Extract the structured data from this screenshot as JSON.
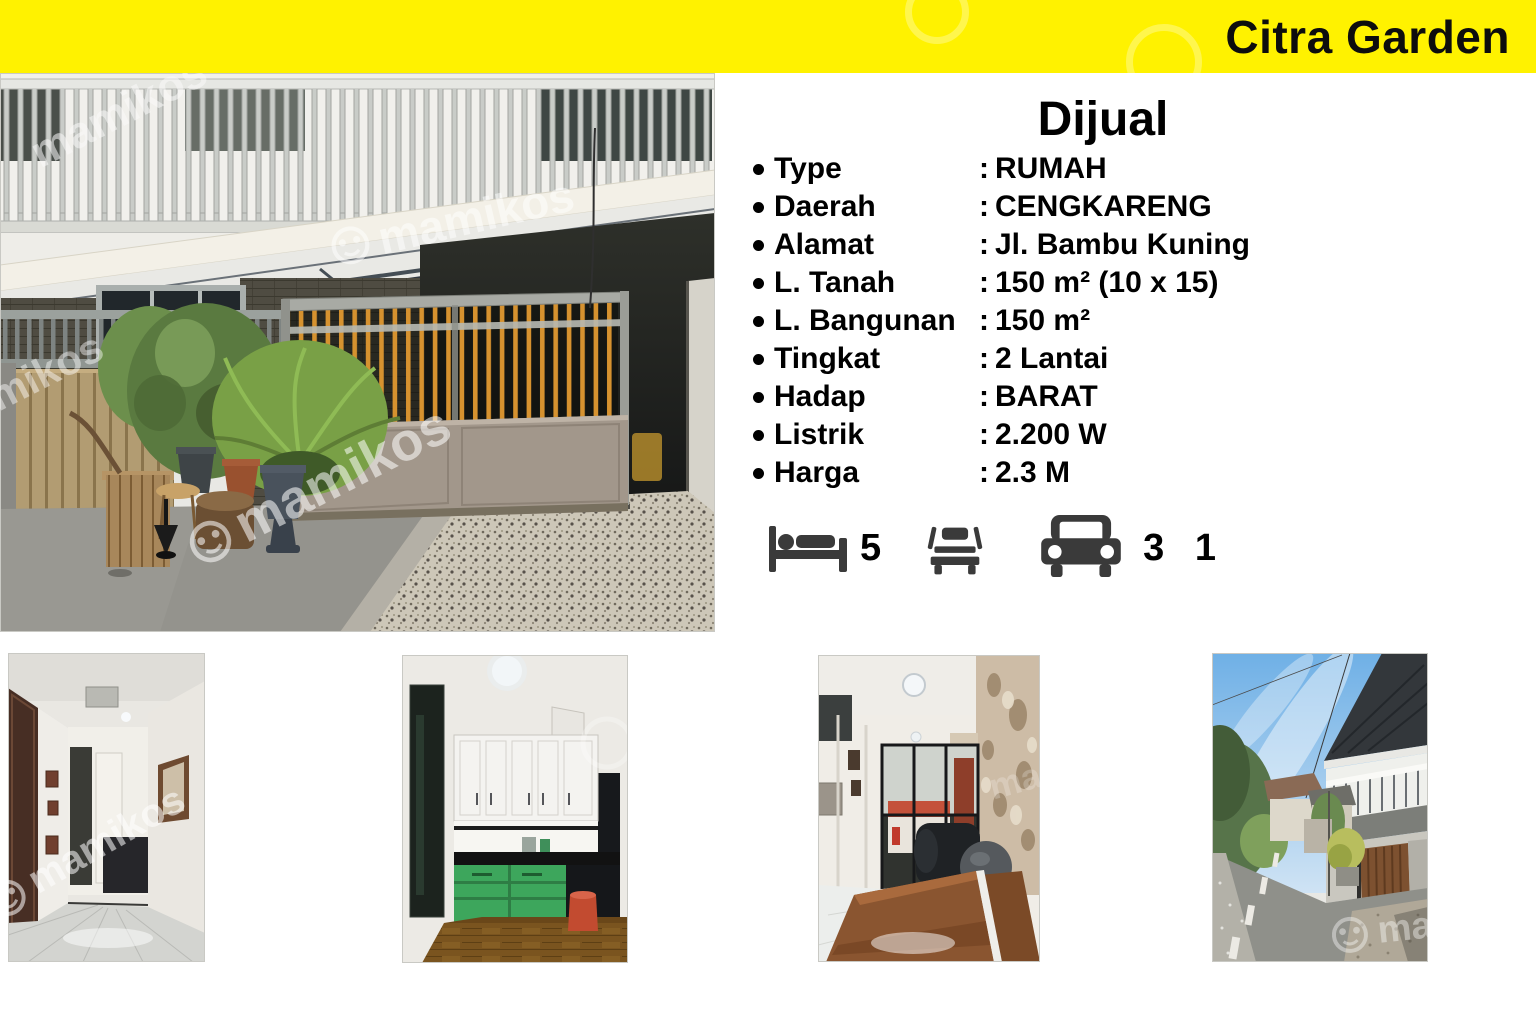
{
  "banner": {
    "title": "Citra Garden",
    "background": "#FFF200"
  },
  "watermark": {
    "text": "mamikos"
  },
  "listing": {
    "title": "Dijual",
    "colon": ":",
    "details": [
      {
        "label": "Type",
        "value": "RUMAH"
      },
      {
        "label": "Daerah",
        "value": "CENGKARENG"
      },
      {
        "label": "Alamat",
        "value": "Jl. Bambu Kuning"
      },
      {
        "label": "L. Tanah",
        "value": "150 m² (10 x 15)"
      },
      {
        "label": "L. Bangunan",
        "value": "150 m²"
      },
      {
        "label": "Tingkat",
        "value": "2 Lantai"
      },
      {
        "label": "Hadap",
        "value": "BARAT"
      },
      {
        "label": "Listrik",
        "value": "2.200 W"
      },
      {
        "label": "Harga",
        "value": "2.3 M"
      }
    ],
    "features": [
      {
        "icon": "bed-icon",
        "count": "5"
      },
      {
        "icon": "bed-front-icon",
        "count": ""
      },
      {
        "icon": "car-icon",
        "count": "3 1"
      }
    ]
  },
  "colors": {
    "banner_bg": "#FFF200",
    "icon": "#3a3a3a",
    "gate_bars": "#D6922F"
  }
}
